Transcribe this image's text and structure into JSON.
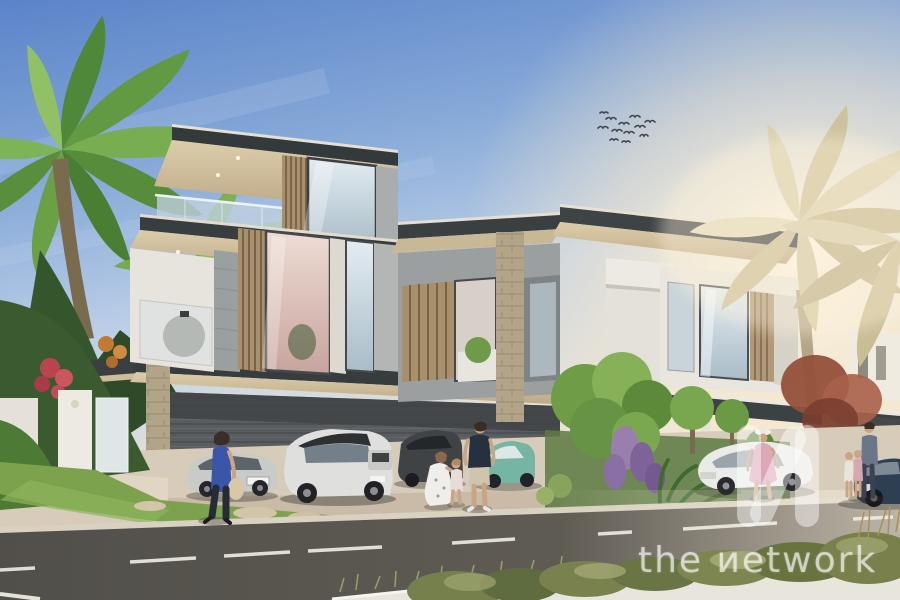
{
  "meta": {
    "type": "architectural-render-photo",
    "subject": "Modern flat-roof twin villas at sunset with palm trees, landscaped garden, parked cars, pedestrians and a street in the foreground"
  },
  "watermark": {
    "brand": "the network",
    "display_text": "the иetwork",
    "logo": "network-monogram-icon",
    "color": "#ffffff",
    "opacity": 0.45
  },
  "palette": {
    "sky_top": "#5b83c9",
    "sky_mid": "#bccfe7",
    "sky_horizon": "#f2e8d6",
    "sun_glow": "#fff3dc",
    "roof_dark": "#383d40",
    "soffit_cream": "#d9c9a7",
    "wall_white": "#e7e4de",
    "wall_gray": "#9aa0a0",
    "wood_slats": "#a8906c",
    "stone": "#b2a488",
    "garage_siding": "#595d5f",
    "glass": "#c2d3dd",
    "road": "#5a5751",
    "pavement": "#d7ccba",
    "grass": "#7ca24e",
    "bush_olive": "#76804d",
    "palm_green": "#5f9a3f",
    "palm_backlit": "#cdc29c",
    "maple_red": "#94503a"
  },
  "scene": {
    "sky": {
      "birds_count": 12,
      "clouds": "faint streaks upper left",
      "glow": "warm sunset glow on right"
    },
    "building": {
      "style": "contemporary flat-roof villas, 3 levels",
      "features": [
        "glass balustrade balconies",
        "vertical wood slat screens",
        "cream soffits with downlights",
        "stone-clad pillars",
        "dark carport with horizontal siding",
        "long entrance pergolas"
      ]
    },
    "vehicles": [
      {
        "name": "silver-sedan",
        "color": "#c9cbc9"
      },
      {
        "name": "white-landrover-suv",
        "color": "#dfe0dd",
        "roof": "#2e3132"
      },
      {
        "name": "dark-suv",
        "color": "#3f4345"
      },
      {
        "name": "teal-compact-car",
        "color": "#76b4a4"
      },
      {
        "name": "white-sedan",
        "color": "#e9ebe8"
      },
      {
        "name": "dark-blue-coupe",
        "color": "#2e3f54"
      }
    ],
    "people": [
      {
        "name": "woman-walking-blue-top",
        "clothes": "#3b55a8"
      },
      {
        "name": "kneeling-woman-white-dress",
        "clothes": "#efeeea"
      },
      {
        "name": "toddler",
        "clothes": "#e8ddd6"
      },
      {
        "name": "man-navy-tshirt-shorts",
        "clothes": "#26303f"
      },
      {
        "name": "woman-pink-dress-hat",
        "clothes": "#dca8b8"
      },
      {
        "name": "man-with-two-children",
        "clothes": "#6b7788"
      }
    ],
    "road": {
      "markings": "white dashed center line",
      "foreground": "light curb strip with olive bushes and grasses"
    }
  }
}
